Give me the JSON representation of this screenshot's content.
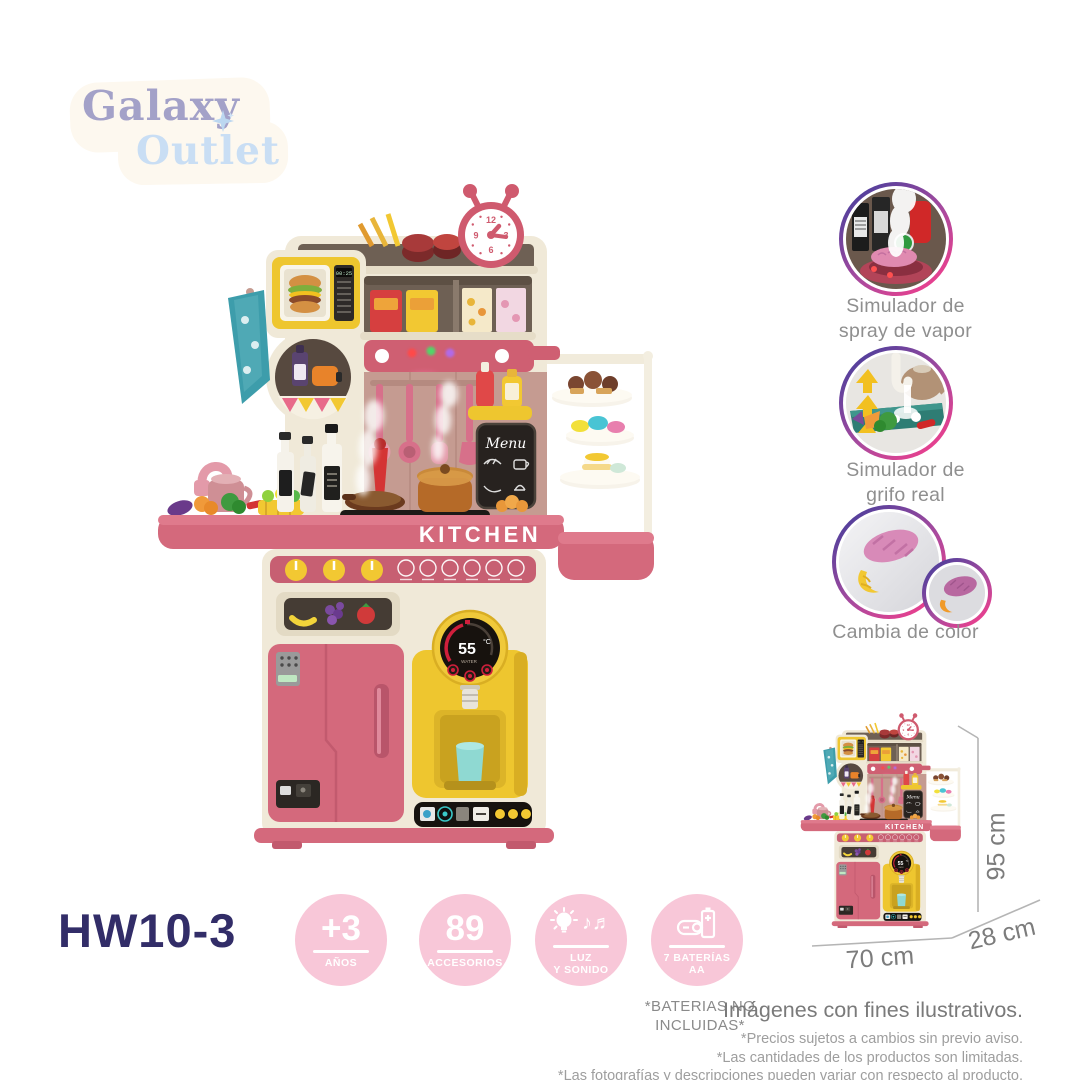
{
  "logo": {
    "word1": "Galaxy",
    "word2": "Outlet",
    "star_icon": "sparkle"
  },
  "product": {
    "model": "HW10-3",
    "sign": "KITCHEN",
    "menu_board": "Menu",
    "microwave_display": "00:25",
    "dispenser": {
      "temp_value": "55",
      "temp_unit": "°C",
      "sub_label": "WATER"
    },
    "clock": {
      "n12": "12",
      "n3": "3",
      "n6": "6",
      "n9": "9"
    }
  },
  "features": [
    {
      "icon": "steam-spray-photo",
      "line1": "Simulador de",
      "line2": "spray de vapor"
    },
    {
      "icon": "real-faucet-photo",
      "line1": "Simulador de",
      "line2": "grifo real"
    },
    {
      "icon": "color-change-photo",
      "line1": "Cambia de color",
      "line2": ""
    }
  ],
  "badges": [
    {
      "value": "+3",
      "label": "AÑOS"
    },
    {
      "value": "89",
      "label": "ACCESORIOS"
    },
    {
      "icon": "lightbulb-and-music-notes",
      "notes_glyph": "♪♬",
      "line1": "LUZ",
      "line2": "Y SONIDO"
    },
    {
      "icon": "aa-batteries",
      "line1": "7 BATERÍAS",
      "line2": "AA"
    }
  ],
  "battery_note": {
    "line1": "*BATERIAS NO",
    "line2": "INCLUIDAS*"
  },
  "dimensions": {
    "height": "95 cm",
    "width": "70 cm",
    "depth": "28 cm"
  },
  "legal": {
    "title": "Imágenes con fines ilustrativos.",
    "lines": [
      "*Precios sujetos a cambios sin previo aviso.",
      "*Las cantidades de los productos son limitadas.",
      "*Las fotografías y descripciones pueden variar  con respecto al producto."
    ]
  },
  "colors": {
    "accent_pink": "#d4697c",
    "strip_pink": "#c75f72",
    "cream": "#f0e9d8",
    "yellow": "#eec62f",
    "badge_pink": "#f8c7d8",
    "navy": "#322d68",
    "gradient_purple": "#4d3f9c",
    "gradient_pink": "#ee3f8d",
    "caption_gray": "#8f8f8f",
    "teal_towel": "#3d9dab",
    "mauve_panel": "#c59b91"
  }
}
